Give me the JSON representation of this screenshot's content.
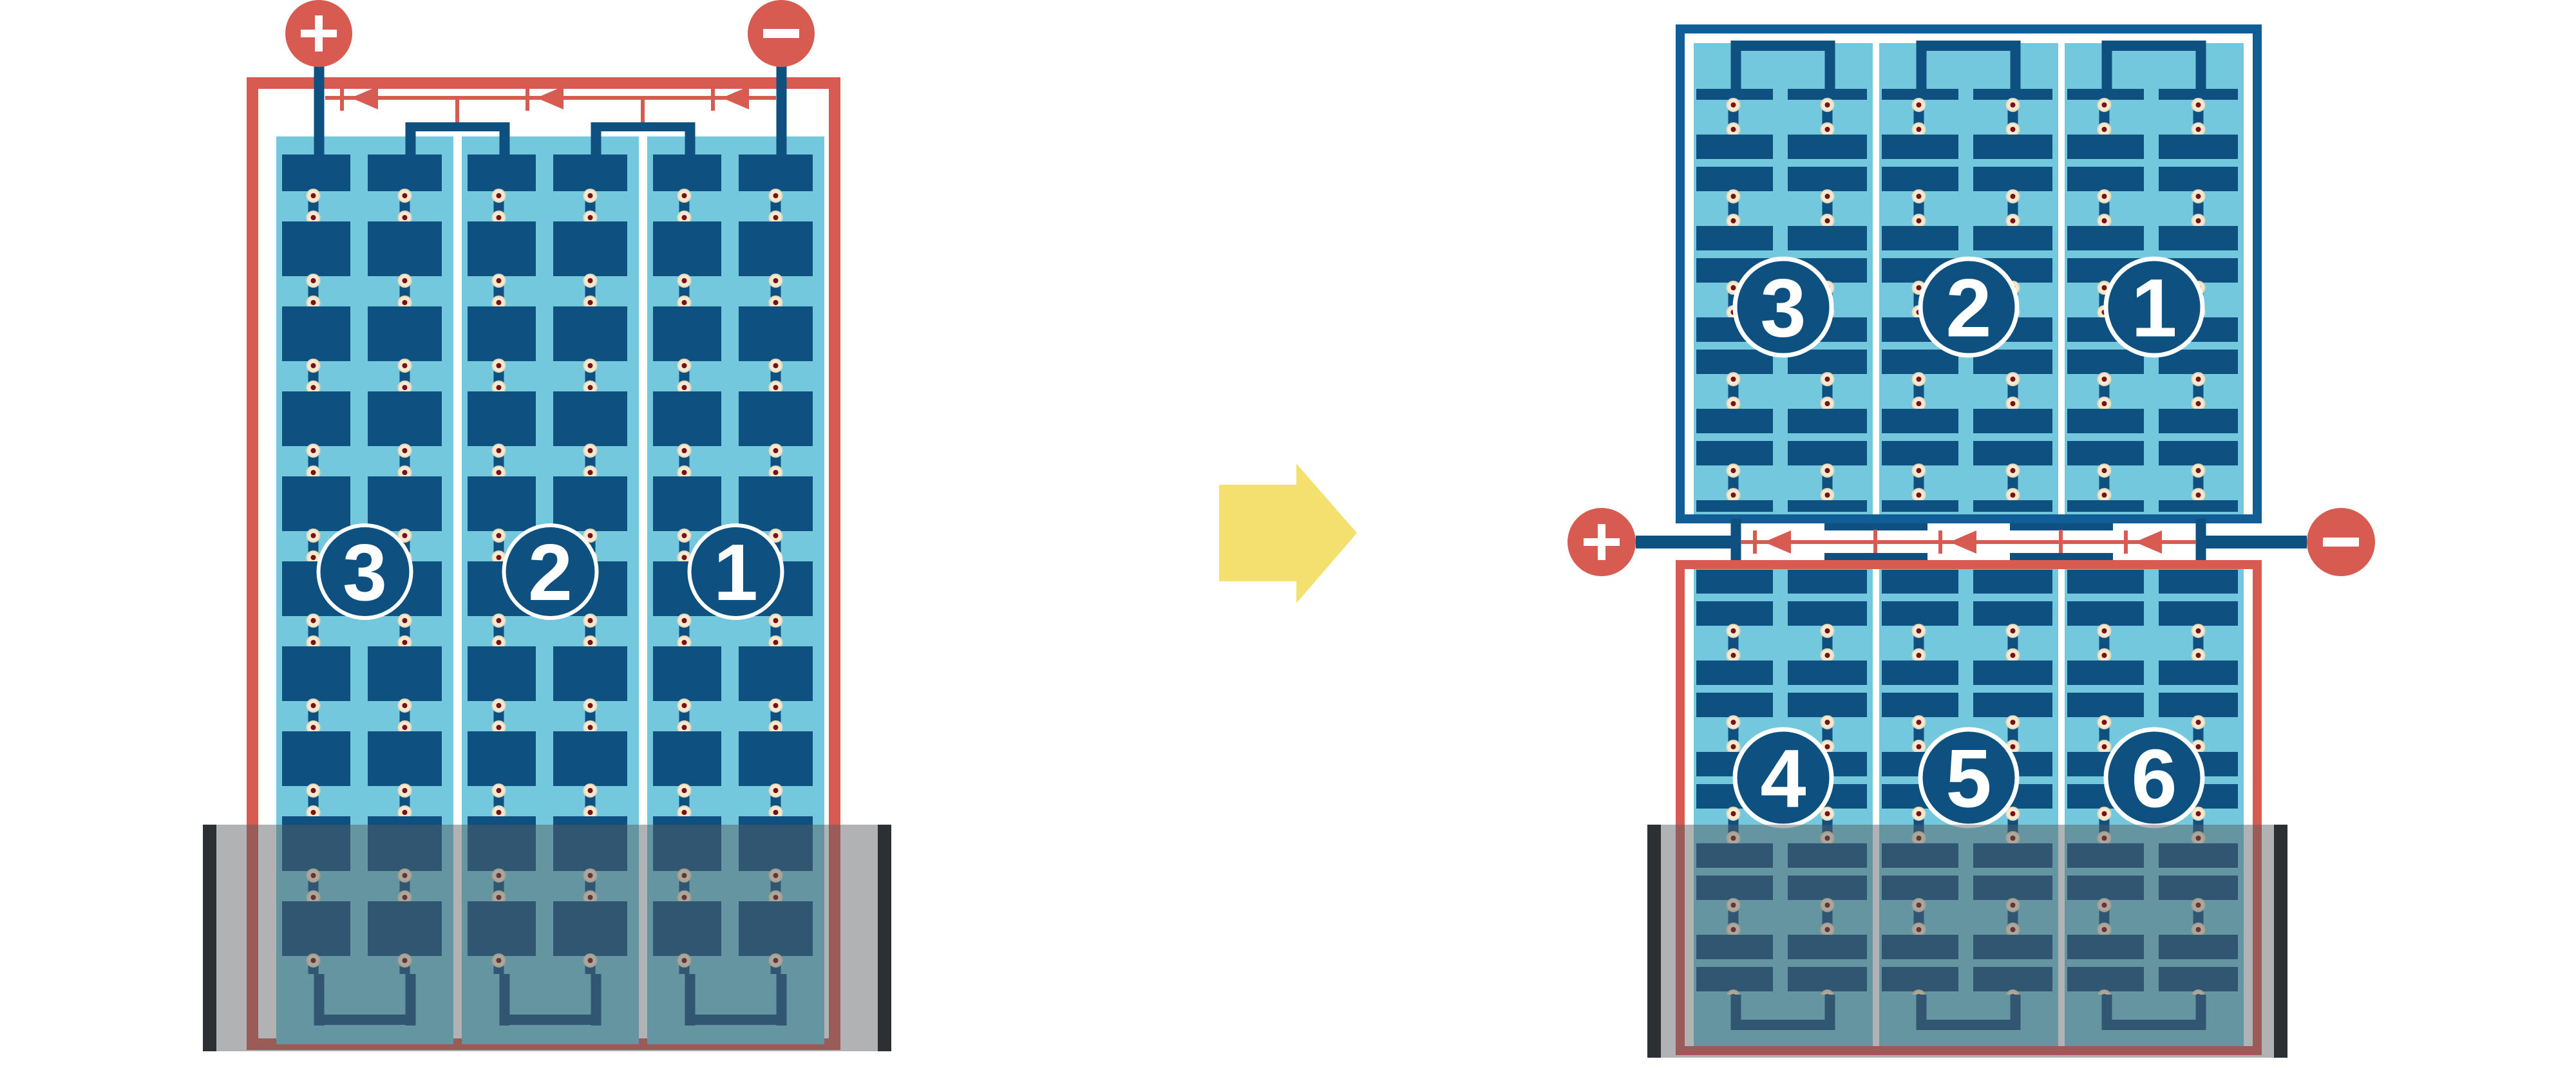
{
  "colors": {
    "background": "#ffffff",
    "red": "#d85b52",
    "cell_navy": "#0e5181",
    "frame_blue": "#115d95",
    "light_blue": "#74c8de",
    "cream": "#f5ead0",
    "cream_rim": "#e4d7bc",
    "maroon": "#7a1117",
    "yellow": "#f3e06e",
    "overlay": "rgba(88,92,96,0.47)",
    "overlay_bar": "#2d3033"
  },
  "before_array": {
    "panel_labels": [
      "3",
      "2",
      "1"
    ],
    "positive_terminal": "+",
    "negative_terminal": "−"
  },
  "transform_arrow": {
    "direction": "right"
  },
  "after_array": {
    "top_string_labels": [
      "3",
      "2",
      "1"
    ],
    "bottom_string_labels": [
      "4",
      "5",
      "6"
    ],
    "positive_terminal": "+",
    "negative_terminal": "−"
  }
}
